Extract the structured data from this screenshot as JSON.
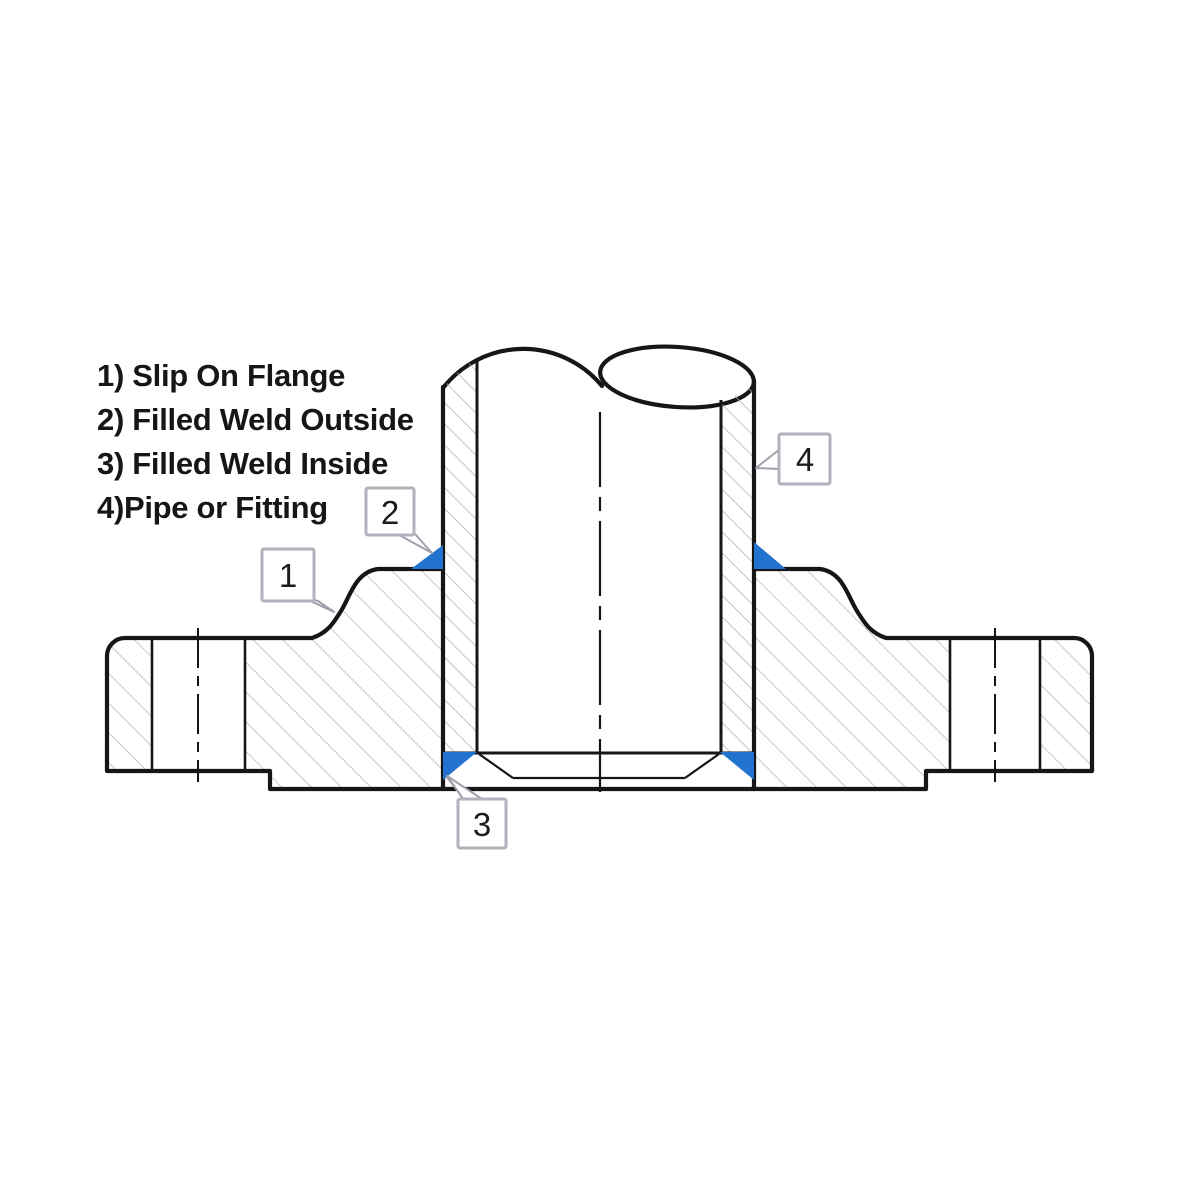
{
  "diagram": {
    "type": "technical-drawing",
    "subject": "Slip-on flange welded to a pipe, cross-section view",
    "legend": {
      "items": [
        {
          "text": "1) Slip On Flange"
        },
        {
          "text": "2) Filled Weld Outside"
        },
        {
          "text": "3) Filled Weld Inside"
        },
        {
          "text": "4)Pipe or Fitting"
        }
      ]
    },
    "callouts": [
      {
        "label": "1",
        "points_to": "slip-on-flange"
      },
      {
        "label": "2",
        "points_to": "fillet-weld-outside"
      },
      {
        "label": "3",
        "points_to": "fillet-weld-inside"
      },
      {
        "label": "4",
        "points_to": "pipe-or-fitting"
      }
    ],
    "colors": {
      "line": "#161616",
      "weld_fill": "#2273cf",
      "hatch": "#b5b5b5",
      "callout_border": "#b2b2bc",
      "leader": "#a0a0ac",
      "background": "#ffffff",
      "text": "#161616"
    }
  }
}
